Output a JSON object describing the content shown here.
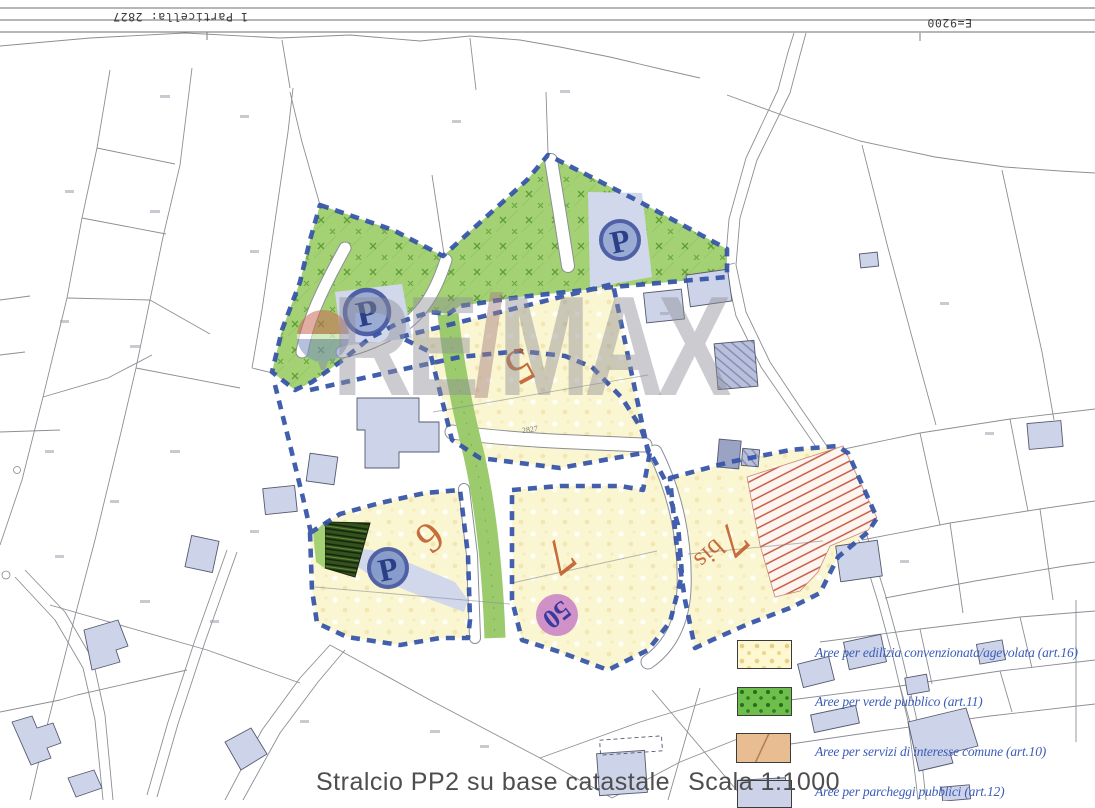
{
  "header": {
    "top_left_label": "1 Particella: 2827",
    "top_right_label": "E=9200"
  },
  "watermark": {
    "left": "RE",
    "slash": "/",
    "right": "MAX"
  },
  "zones": {
    "z5": "5",
    "z6": "6",
    "z7": "7",
    "z7bis_main": "7",
    "z7bis_suffix": "bis",
    "badge_50": "50",
    "parking_letter": "P",
    "parcel_2827": "2827"
  },
  "legend": {
    "items": [
      {
        "id": "edilizia",
        "label": "Aree per edilizia convenzionata/agevolata (art.16)",
        "swatch": "#fdf8cf"
      },
      {
        "id": "verde",
        "label": "Aree per verde pubblico (art.11)",
        "swatch": "#6cbf4a"
      },
      {
        "id": "servizi",
        "label": "Aree per servizi di interesse comune (art.10)",
        "swatch": "#e9bd92"
      },
      {
        "id": "parcheggi",
        "label": "Aree per parcheggi pubblici (art.12)",
        "swatch": "#ccd3e8"
      }
    ]
  },
  "footer": {
    "title": "Stralcio PP2 su base catastale",
    "scale": "Scala 1:1000"
  },
  "colors": {
    "boundary_dash": "#3352a8",
    "green_area": "#a4d173",
    "yellow_area": "#fbf6d2",
    "services_hatch": "#c6503c",
    "parking_area": "#d2d8ec",
    "zone_number": "#c05a28",
    "badge_50_fill": "#c77fc5",
    "legend_text": "#3a5cb8",
    "building_fill": "#cdd3e8"
  }
}
